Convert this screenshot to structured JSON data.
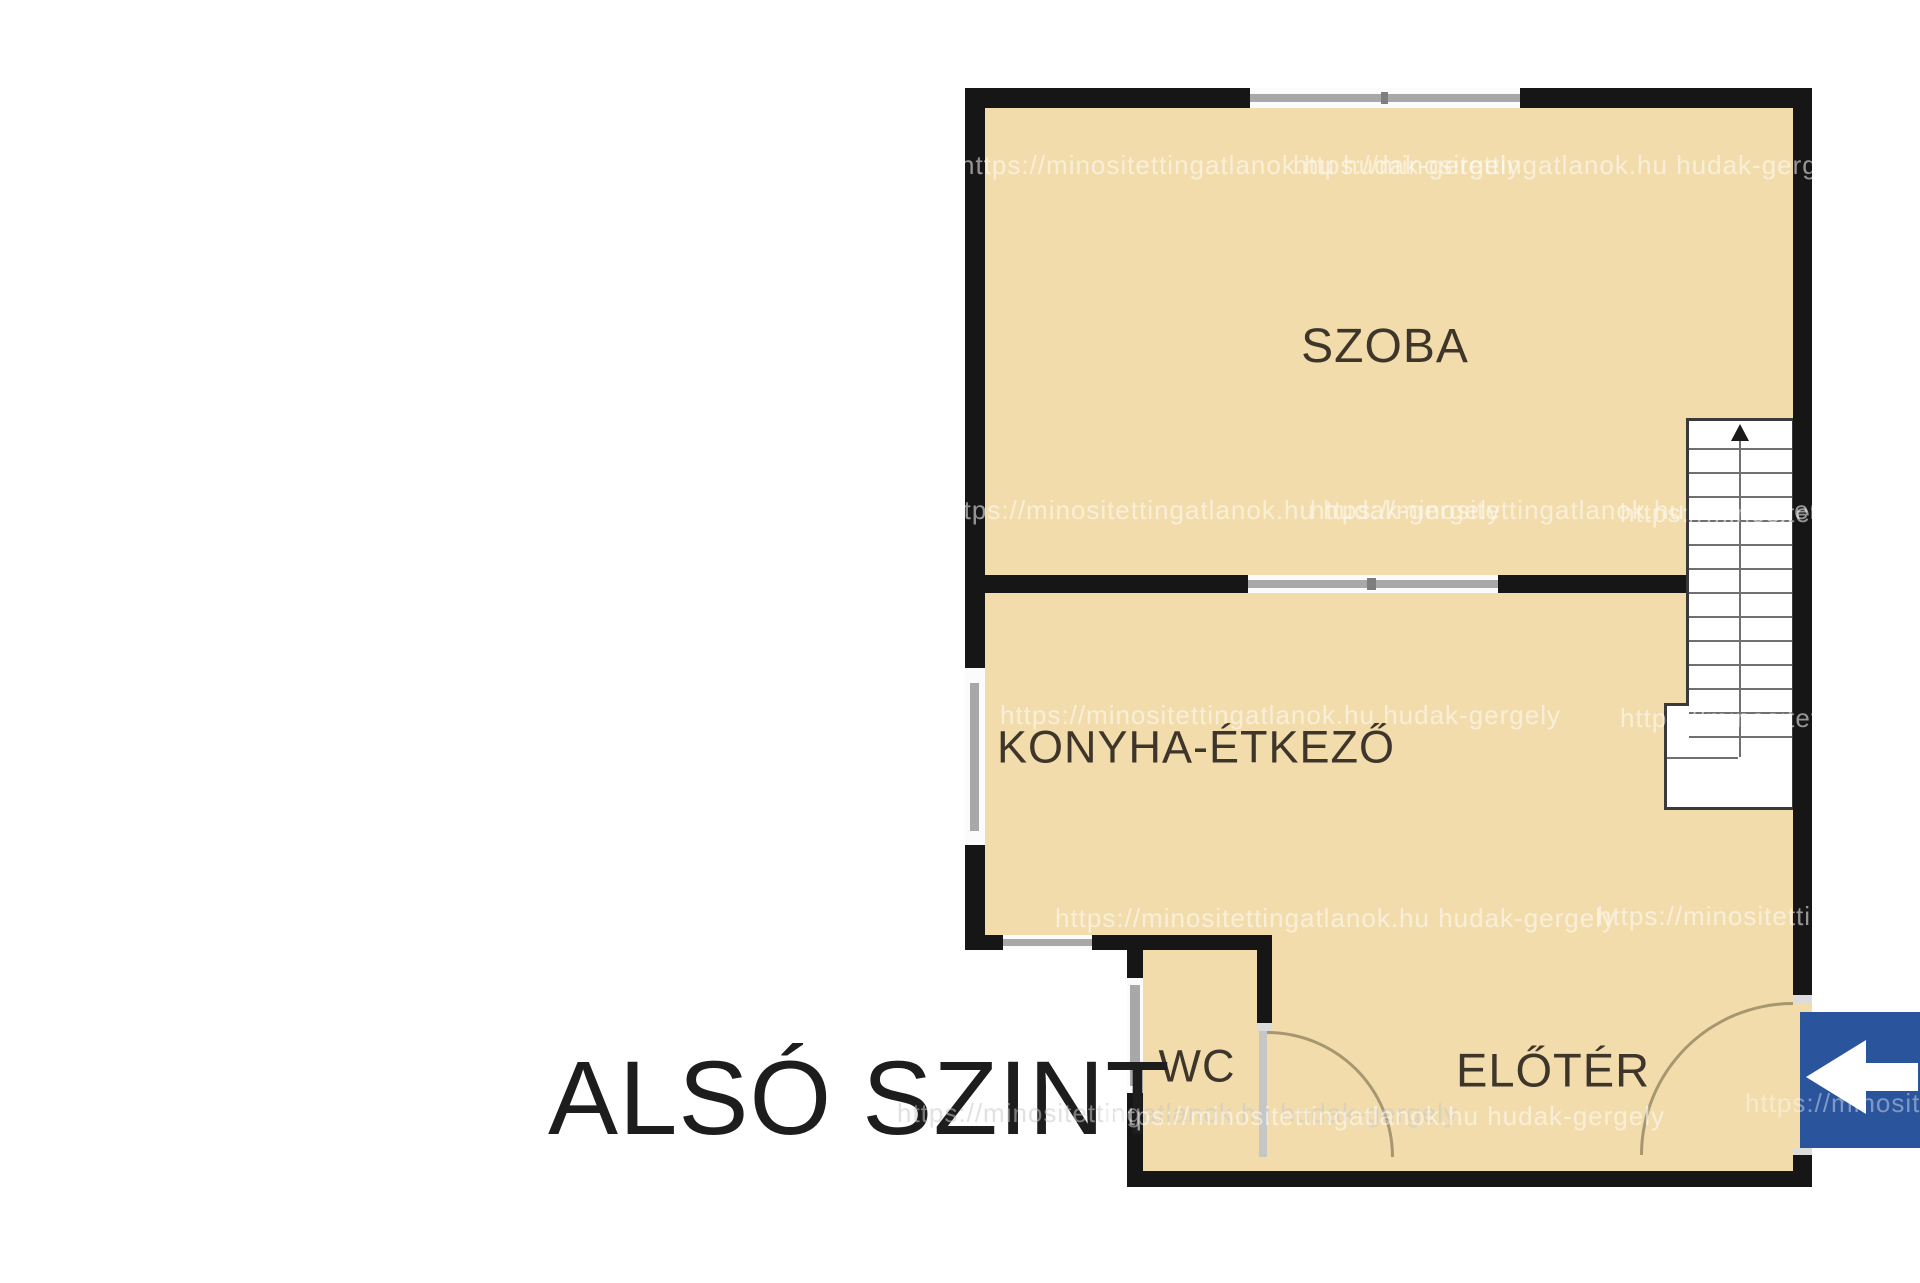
{
  "title": "ALSÓ SZINT",
  "rooms": [
    {
      "id": "szoba",
      "label": "SZOBA"
    },
    {
      "id": "konyha",
      "label": "KONYHA-ÉTKEZŐ"
    },
    {
      "id": "wc",
      "label": "WC"
    },
    {
      "id": "eloter",
      "label": "ELŐTÉR"
    }
  ],
  "stairs": {
    "treads": 13,
    "direction": "up"
  },
  "arrow_sign": {
    "direction": "left",
    "color": "#2a549b"
  },
  "watermark": {
    "text": "https://minositettingatlanok.hu hudak-gergely"
  },
  "colors": {
    "room_fill": "#f2dcab",
    "wall": "#161616",
    "window": "#a8a8a8",
    "label_text": "#3e362a",
    "title_text": "#1d1d1d",
    "door_arc": "#a79770",
    "stairs_line": "#707070",
    "sign_blue": "#2a549b"
  }
}
